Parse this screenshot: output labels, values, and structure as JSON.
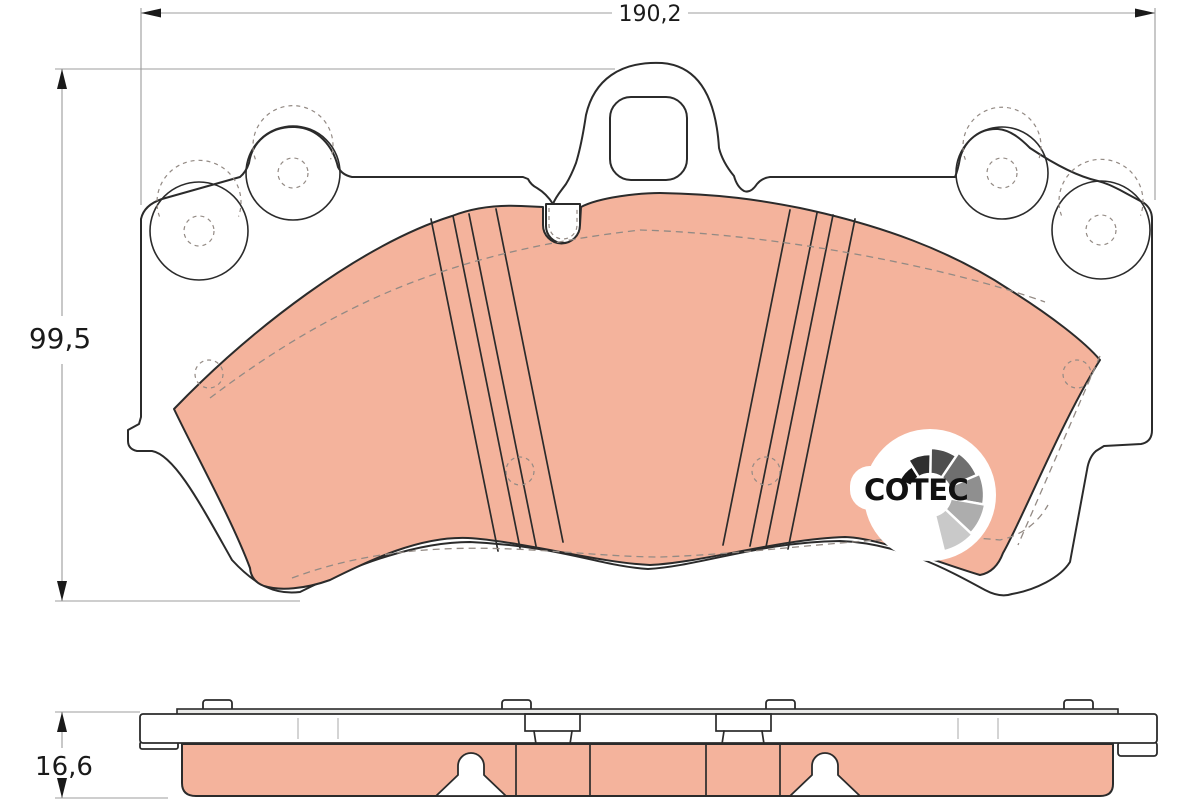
{
  "drawing": {
    "type": "brake-pad-technical-drawing",
    "dimensions": {
      "width_label": "190,2",
      "height_label": "99,5",
      "thickness_label": "16,6"
    },
    "logo": {
      "text": "COTEC"
    }
  },
  "colors": {
    "background": "#ffffff",
    "friction": "#f4b39c",
    "outline": "#2b2b2b",
    "hidden_line": "#938a84",
    "dim_line": "#9c9c9c",
    "dim_text": "#1a1a1a",
    "shim_fill": "#e9e9e7",
    "logo_text": "#111111",
    "logo_shades": "#141414,#2f2f2f,#4e4e4e,#6f6f6f,#8f8f8f,#adadad,#c9c9c9"
  }
}
